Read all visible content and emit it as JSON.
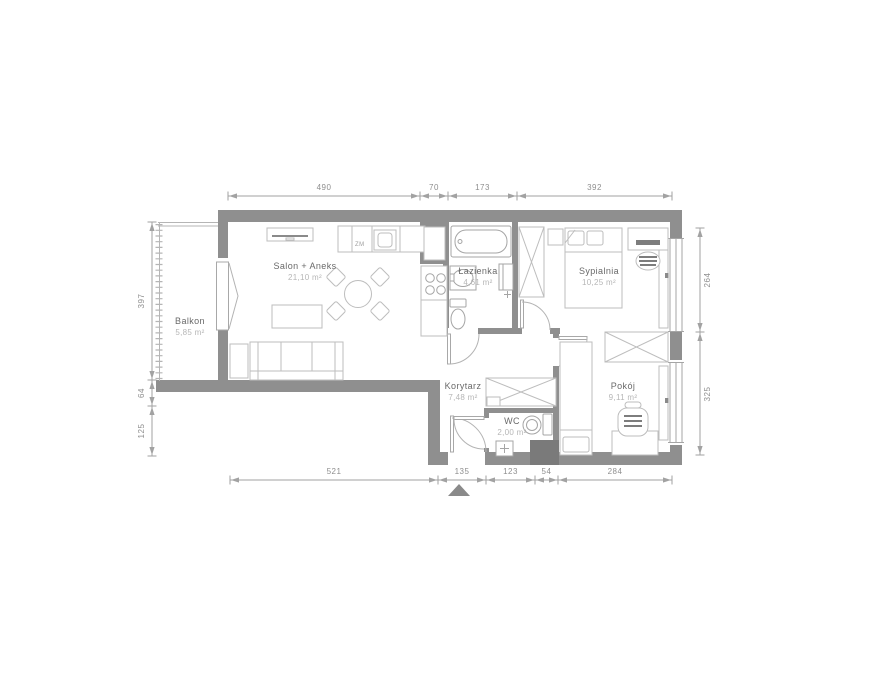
{
  "plan": {
    "rooms": [
      {
        "name": "Balkon",
        "area": "5,85 m²"
      },
      {
        "name": "Salon + Aneks",
        "area": "21,10 m²"
      },
      {
        "name": "Łazienka",
        "area": "4,61 m²"
      },
      {
        "name": "Sypialnia",
        "area": "10,25 m²"
      },
      {
        "name": "Korytarz",
        "area": "7,48 m²"
      },
      {
        "name": "WC",
        "area": "2,00 m²"
      },
      {
        "name": "Pokój",
        "area": "9,11 m²"
      }
    ],
    "appliance_labels": {
      "dishwasher": "ZM"
    },
    "dimensions": {
      "top": [
        "490",
        "70",
        "173",
        "392"
      ],
      "bottom": [
        "521",
        "135",
        "123",
        "54",
        "284"
      ],
      "left": [
        "397",
        "64",
        "125"
      ],
      "right": [
        "264",
        "325"
      ]
    },
    "colors": {
      "wall": "#8f8f8f",
      "shaft": "#7a7a7a",
      "furniture_line": "#bdbdbd",
      "fixture_line": "#a5a5a5",
      "door_arc": "#b3b3b3",
      "room_name_text": "#696969",
      "room_area_text": "#b6b6b6",
      "dimension_text": "#8e8e8e",
      "background": "#ffffff"
    }
  }
}
